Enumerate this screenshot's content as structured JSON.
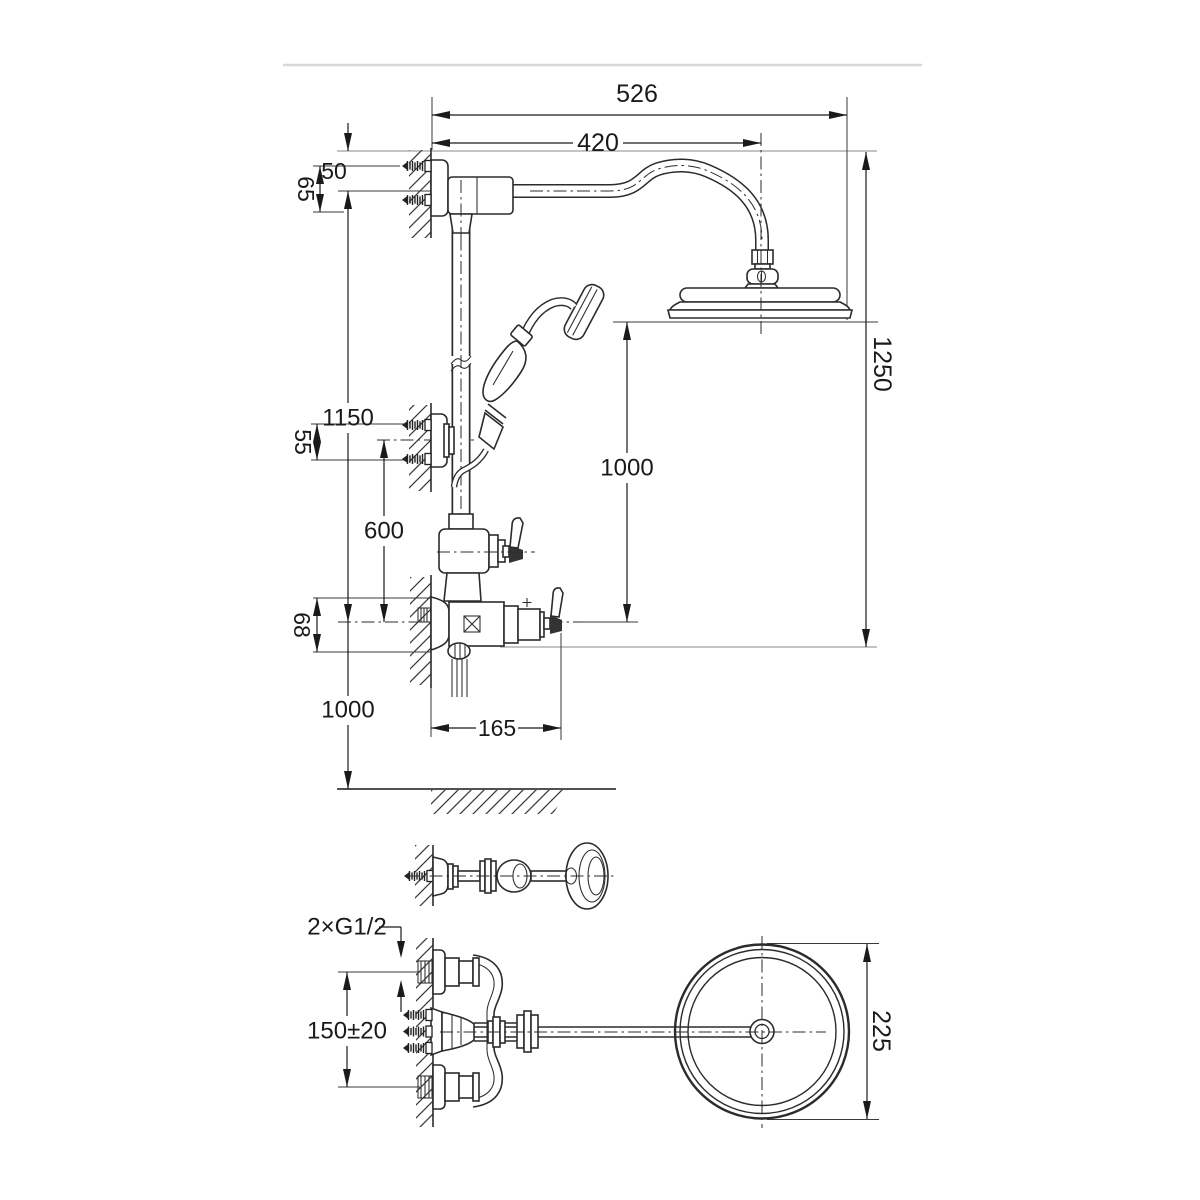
{
  "dims": {
    "total_width": "526",
    "arm_reach": "420",
    "top_offset": "50",
    "top_flange": "65",
    "bracket_height": "1150",
    "bracket_screws": "55",
    "bracket_to_mixer": "600",
    "mixer_body_height": "68",
    "mixer_to_floor": "1000",
    "head_to_mixer": "1000",
    "total_height": "1250",
    "mixer_depth": "165",
    "thread_label": "2×G1/2",
    "inlet_spacing": "150±20",
    "head_diameter": "225"
  }
}
